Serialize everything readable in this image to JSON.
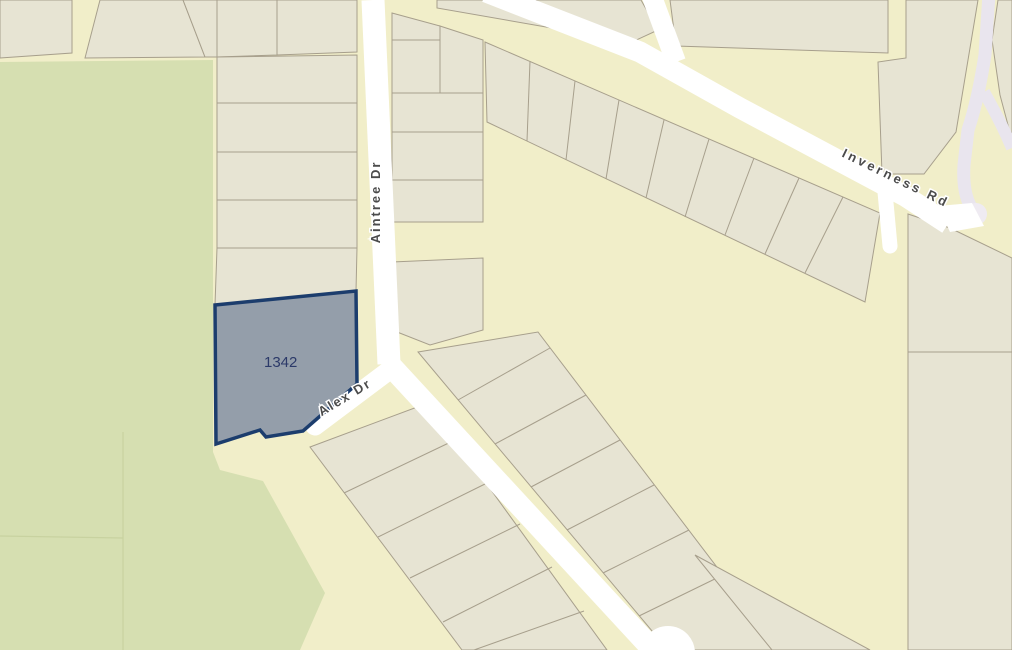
{
  "map_view": {
    "type": "parcel-map",
    "selected_parcel": {
      "number": "1342",
      "fill_color": "#8d99a8",
      "outline_color": "#1c3d6d"
    },
    "road_labels": {
      "aintree": "Aintree  Dr",
      "alex": "Alex  Dr",
      "inverness": "Inverness  Rd"
    },
    "features": {
      "greenspace": "park-open-space",
      "cul_de_sac": "road-end-bulb",
      "dead_end_stub": "short-road-stub"
    },
    "colors": {
      "street_block_background": "#f1eec9",
      "parcel_fill": "#e7e4d3",
      "parcel_outline": "#a79f8c",
      "greenspace_fill": "#d6dfb1",
      "road_fill": "#ffffff",
      "secondary_road_fill": "#e9e5ee",
      "road_label_text": "#4b4b4b",
      "parcel_number_text": "#2c3a69"
    }
  }
}
